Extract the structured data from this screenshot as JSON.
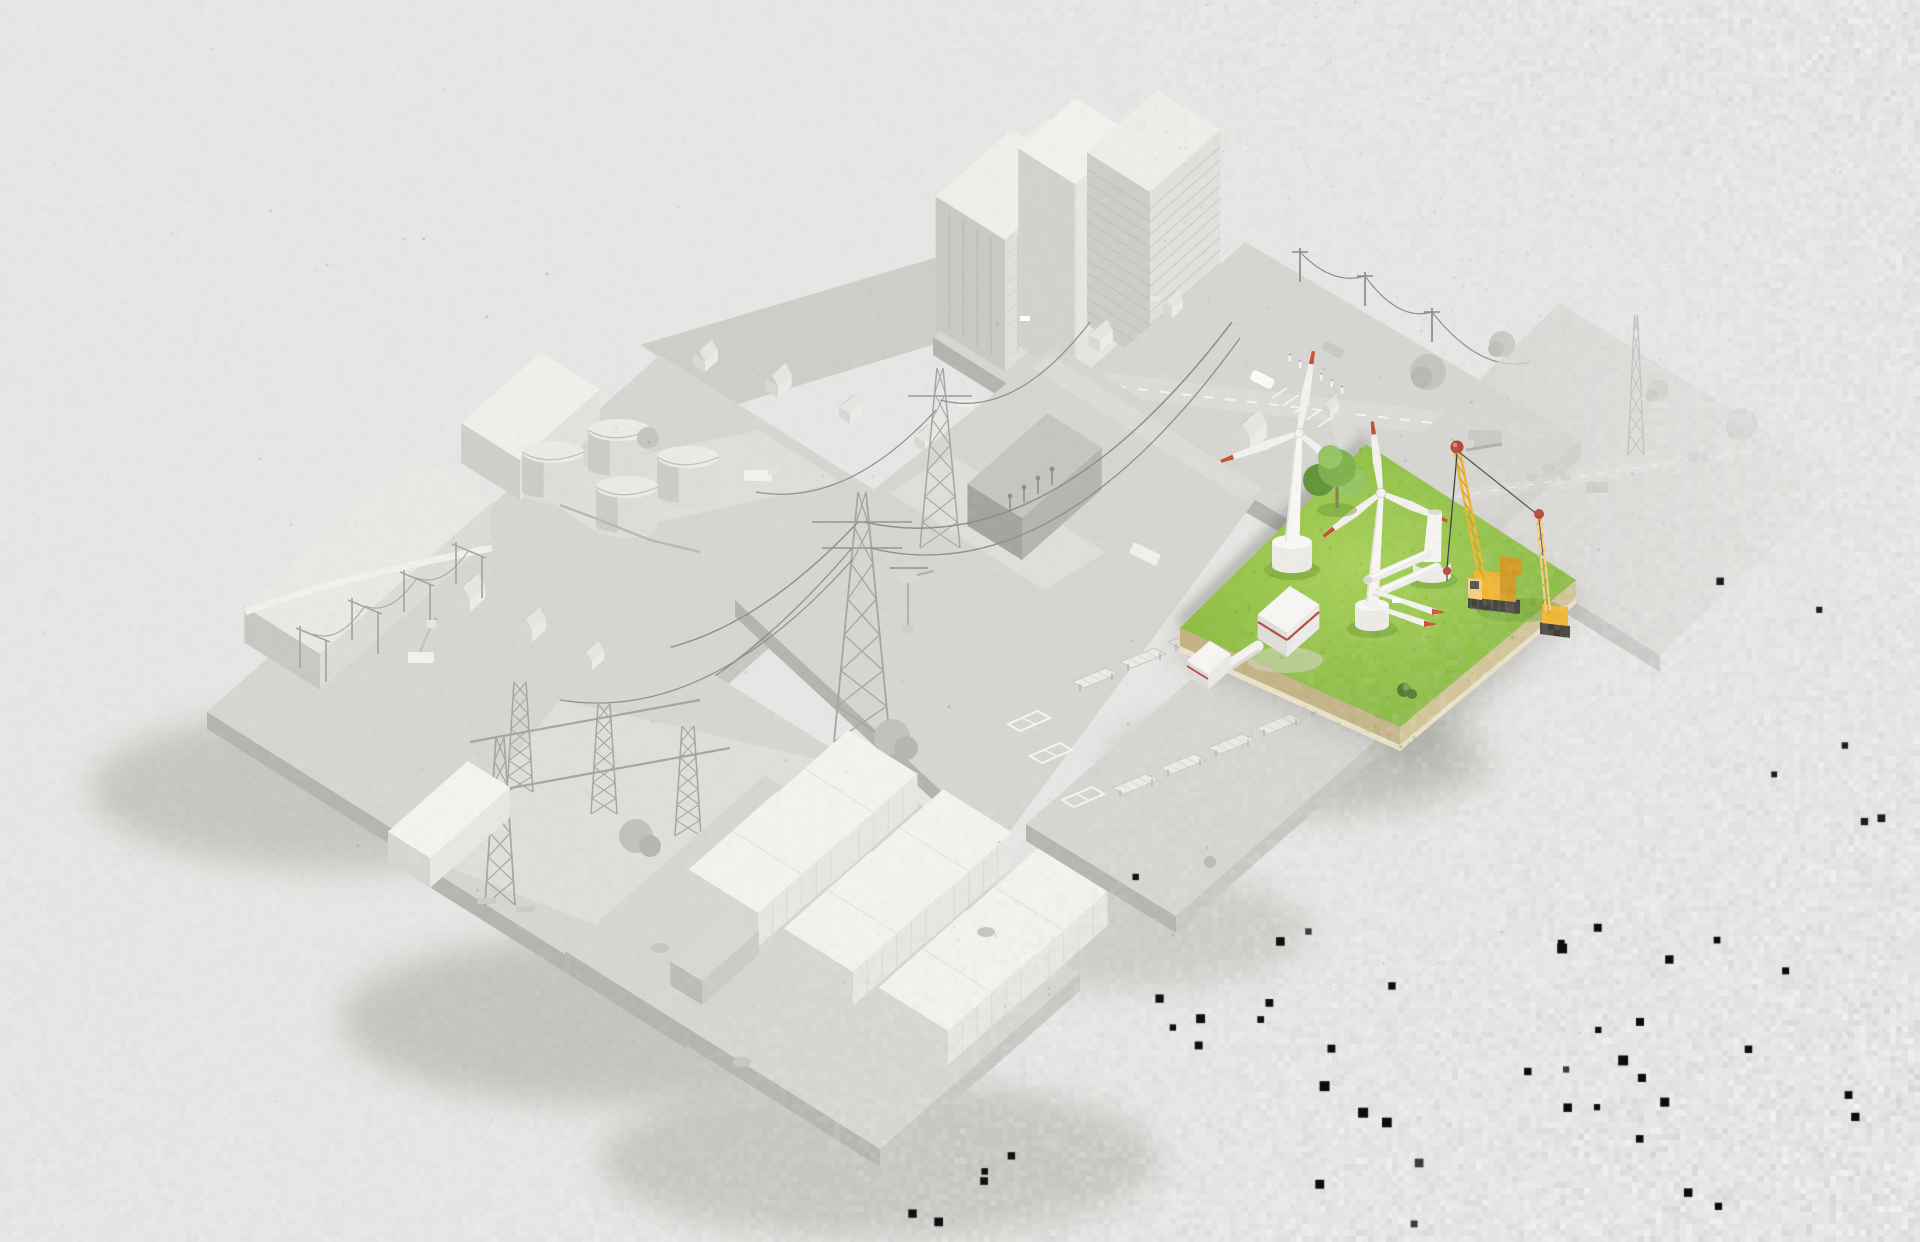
{
  "page": {
    "title": "Isometric 3D energy infrastructure illustration",
    "description": "Patchwork of greyed-out isometric energy tiles with one highlighted green tile showing a wind farm under construction",
    "visible_text": "",
    "artifacts": "image compression speckle noise across background, dense white blocky noise toward right and bottom-right, scattered black square artifacts in lower-right region"
  },
  "colors": {
    "bg": "#e7e6e4",
    "tileTop": "#d6d5d2",
    "tileTopAlt": "#cecdc9",
    "sideR": "#c7c6c3",
    "sideL": "#b4b3b0",
    "pad": "#dfdedb",
    "roadFill": "#dcdbd8",
    "objWhite": "#f1f0ed",
    "objLight": "#e4e3e0",
    "objMid": "#d2d1ce",
    "objDark": "#bbbab7",
    "line": "#a5a4a1",
    "lineDark": "#8e8d8a",
    "shadow": "#8f8f88",
    "grass": "#8abc3f",
    "grassLight": "#a7d057",
    "grassDark": "#76a934",
    "soil": "#c4b284",
    "soilLight": "#d2c396",
    "soilRim": "#e9e2c8",
    "craneYellow": "#f0b42c",
    "craneShade": "#d2981c",
    "craneLight": "#f5cf82",
    "trackDark": "#3e3d36",
    "accentRed": "#b5483b",
    "bladeTip": "#c4512f",
    "tree": "#7fb14e",
    "treeDark": "#639539",
    "treeLight": "#94c463",
    "bush": "#4e7a2b",
    "trunk": "#8a7b5a"
  },
  "tiles": [
    {
      "id": "city-district",
      "label": "City district with high-rise buildings",
      "state": "inactive"
    },
    {
      "id": "suburb-ev",
      "label": "Suburb with houses and EV charging parking",
      "state": "inactive"
    },
    {
      "id": "farmland-mast",
      "label": "Farmland with measurement mast and vehicles",
      "state": "inactive"
    },
    {
      "id": "tank-farm",
      "label": "Storage tank farm",
      "state": "inactive"
    },
    {
      "id": "transmission-corridor",
      "label": "High-voltage transmission with helicopter maintenance",
      "state": "inactive"
    },
    {
      "id": "warehouse-yard",
      "label": "Warehouse and utility yard",
      "state": "inactive"
    },
    {
      "id": "substation",
      "label": "Electrical substation",
      "state": "inactive"
    },
    {
      "id": "solar-park",
      "label": "Solar park under construction",
      "state": "inactive"
    },
    {
      "id": "battery-storage",
      "label": "Battery storage container park",
      "state": "inactive"
    },
    {
      "id": "wind-farm-construction",
      "label": "Highlighted green site: wind farm under construction with cranes",
      "state": "highlighted",
      "items": [
        "wind-turbine",
        "wind-turbine",
        "tower-stub",
        "crawler-crane",
        "assist-crane",
        "rotor-blades-on-ground",
        "tower-segments-on-ground",
        "transformer-station",
        "cable-bridge",
        "tree",
        "bush"
      ]
    }
  ]
}
